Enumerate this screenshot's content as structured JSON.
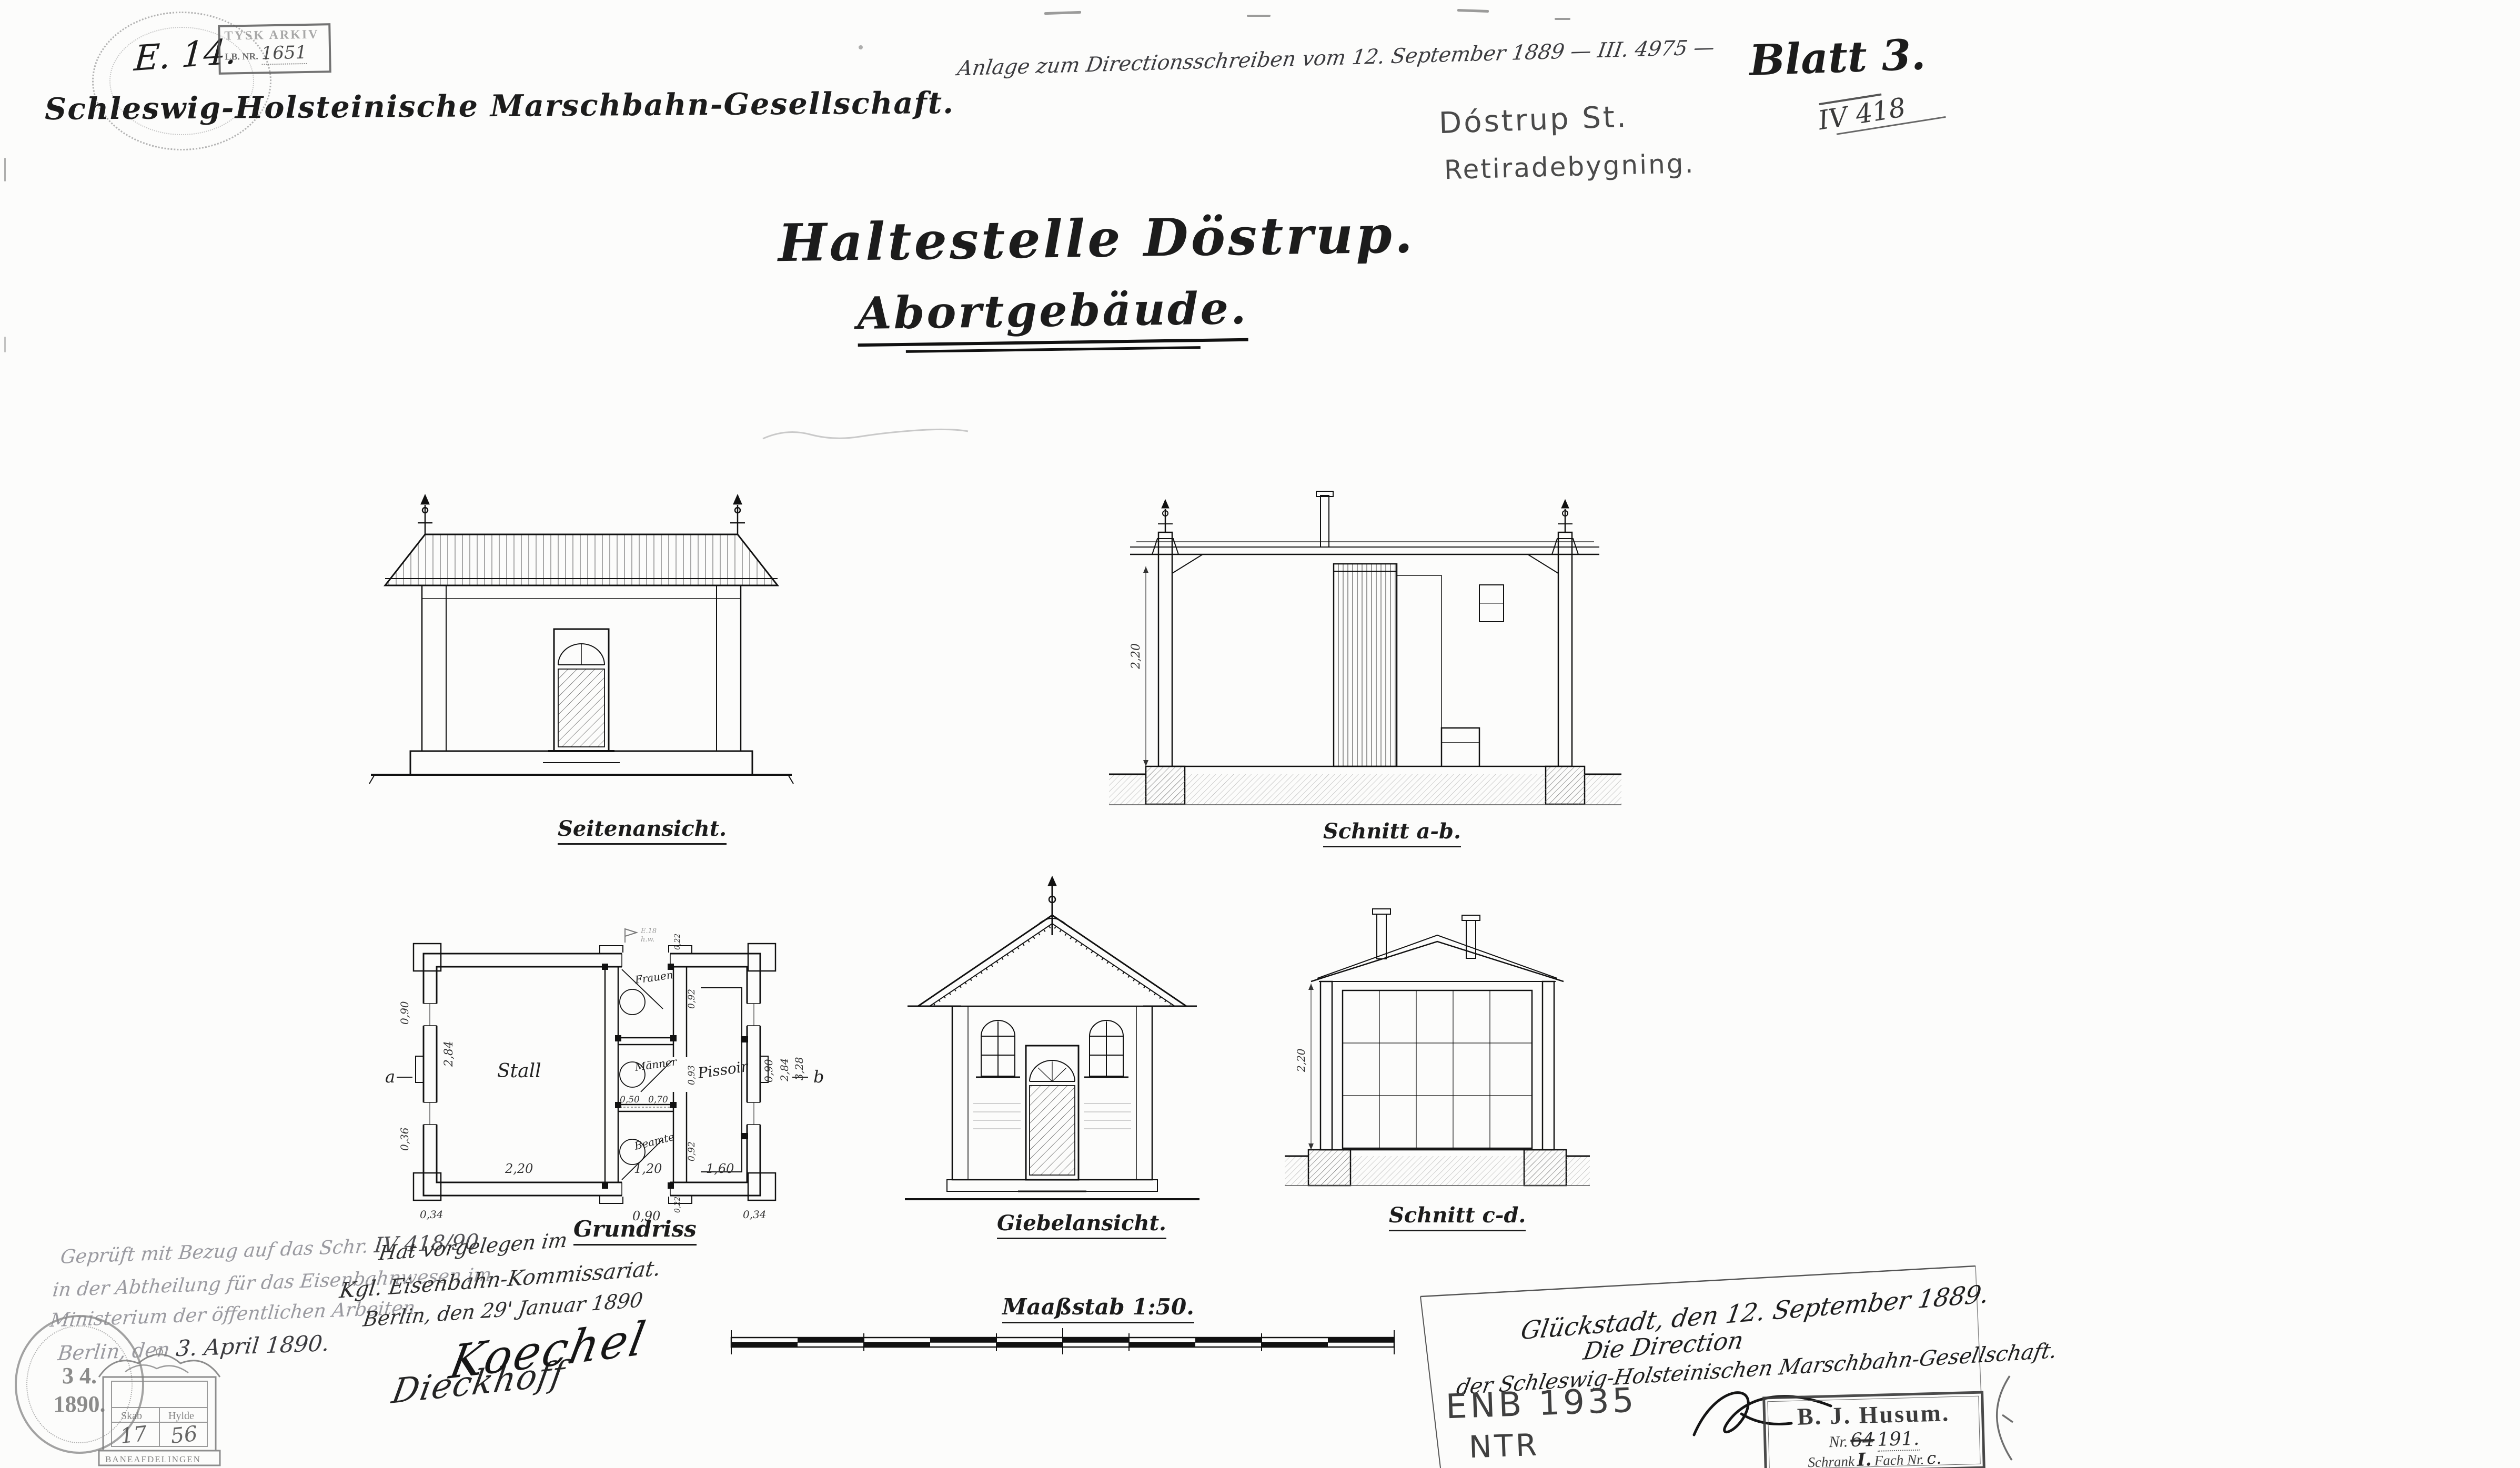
{
  "archive": {
    "e_number": "E. 14.",
    "tysk_line1": "TYSK ARKIV",
    "tysk_line2": "LB. NR.",
    "tysk_number": "1651"
  },
  "header": {
    "company": "Schleswig-Holsteinische Marschbahn-Gesellschaft.",
    "annotation": "Anlage zum Directionsschreiben vom 12. September 1889 — III. 4975 —",
    "blatt": "Blatt 3.",
    "file_number": "IV 418",
    "pencil_station": "Dóstrup St.",
    "pencil_building": "Retiradebygning."
  },
  "title": {
    "line1": "Haltestelle Döstrup.",
    "line2": "Abortgebäude."
  },
  "views": {
    "seitenansicht": {
      "label": "Seitenansicht."
    },
    "schnitt_ab": {
      "label": "Schnitt a-b.",
      "dim_height": "2,20"
    },
    "grundriss": {
      "label": "Grundriss",
      "rooms": {
        "stall": "Stall",
        "frauen": "Frauen",
        "maenner": "Männer",
        "beamte": "Beamte",
        "pissoir": "Pissoir"
      },
      "dims": {
        "stall_width": "2,20",
        "mid_width": "1,20",
        "pissoir_width": "1,60",
        "door_width": "0,90",
        "corner_left": "0,34",
        "corner_right": "0,34",
        "cell_top": "0,92",
        "cell_mid": "0,93",
        "cell_bot": "0,92",
        "split_left": "0,50",
        "split_right": "0,70",
        "left_height": "2,84",
        "left_upper": "0,90",
        "left_lower": "0,36",
        "right_inner": "0,90",
        "right_mid": "2,84",
        "right_outer": "3,28",
        "wall_top": "0,22",
        "wall_bottom": "0,22"
      },
      "section_a": "a",
      "section_b": "b",
      "flag_note1": "E.18",
      "flag_note2": "h.w."
    },
    "giebelansicht": {
      "label": "Giebelansicht."
    },
    "schnitt_cd": {
      "label": "Schnitt c-d.",
      "dim_height": "2,20"
    },
    "massstab": {
      "label": "Maaßstab 1:50."
    }
  },
  "approval_berlin": {
    "line1a": "Geprüft mit Bezug auf das Schr.",
    "line1b": "IV 418/90",
    "line2": "in der Abtheilung für das Eisenbahnwesen im",
    "line3": "Ministerium der öffentlichen Arbeiten.",
    "line4a": "Berlin, den",
    "line4b": "3. April 1890.",
    "signature": "Dieckhoff"
  },
  "approval_kommissariat": {
    "line1": "Hat vorgelegen im",
    "line2": "Kgl. Eisenbahn-Kommissariat.",
    "line3": "Berlin, den 29' Januar 1890",
    "signature": "Koechel"
  },
  "direction": {
    "line1": "Glückstadt, den 12. September 1889.",
    "line2": "Die Direction",
    "line3": "der Schleswig-Holsteinischen Marschbahn-Gesellschaft."
  },
  "husum_stamp": {
    "title": "B. J. Husum.",
    "nr_label": "Nr.",
    "nr_old": "64",
    "nr_new": "191.",
    "schrank_label": "Schrank",
    "schrank_value": "I.",
    "fach_label": "Fach Nr.",
    "fach_value": "c."
  },
  "pencil_codes": {
    "line1": "ENB 1935",
    "line2": "NTR"
  },
  "date_stamp": {
    "line1": "3 4.",
    "line2": "1890."
  },
  "cabinet_stamp": {
    "col1": "Skab",
    "col2": "Hylde",
    "val1": "17",
    "val2": "56",
    "footer": "BANEAFDELINGEN"
  }
}
